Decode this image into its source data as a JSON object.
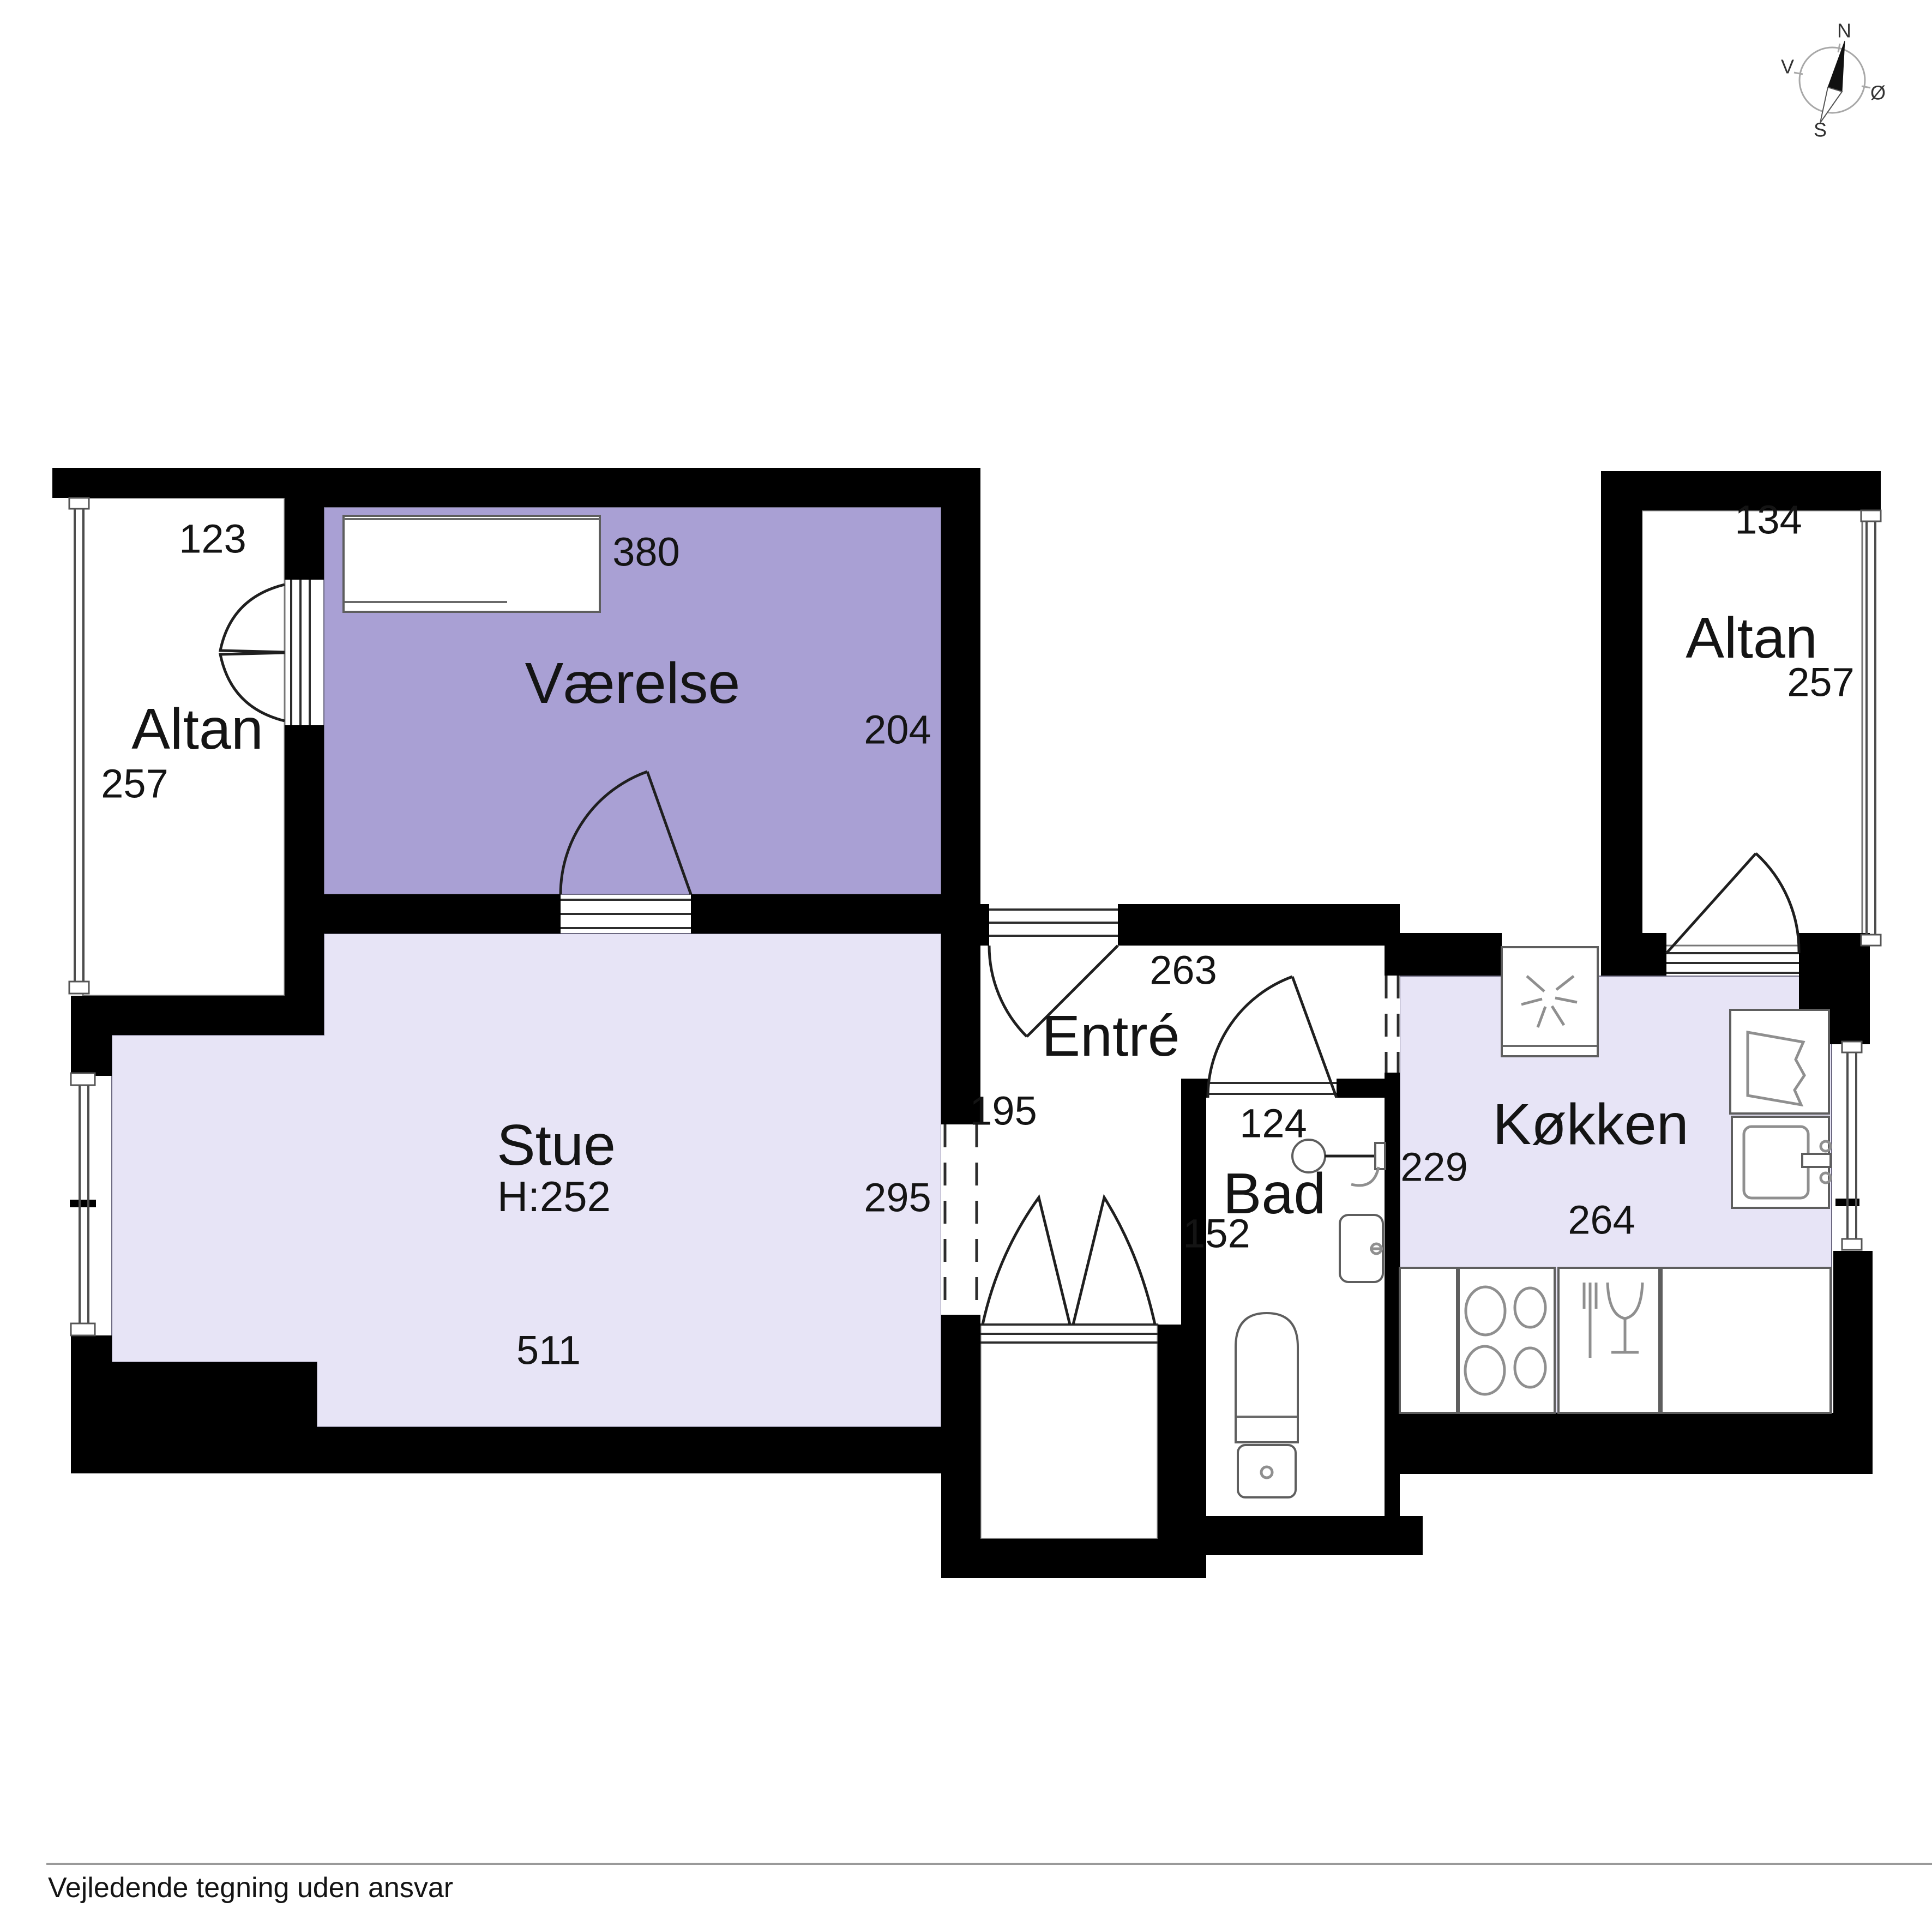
{
  "colors": {
    "wall": "#000000",
    "room_purple": "#a9a0d4",
    "room_light": "#e7e4f6"
  },
  "compass": {
    "north": "N",
    "south": "S",
    "east": "Ø",
    "west": "V"
  },
  "rooms": {
    "altan_left": {
      "name": "Altan",
      "width": "123",
      "depth": "257"
    },
    "vaerelse": {
      "name": "Værelse",
      "width": "380",
      "depth": "204"
    },
    "stue": {
      "name": "Stue",
      "ceiling": "H:252",
      "width": "511",
      "depth": "295",
      "opening": "195"
    },
    "entre": {
      "name": "Entré",
      "width": "263"
    },
    "bad": {
      "name": "Bad",
      "width": "124",
      "depth": "152"
    },
    "koekken": {
      "name": "Køkken",
      "left": "229",
      "width": "264"
    },
    "altan_right": {
      "name": "Altan",
      "width": "134",
      "depth": "257"
    }
  },
  "footer": {
    "disclaimer": "Vejledende tegning uden ansvar"
  }
}
